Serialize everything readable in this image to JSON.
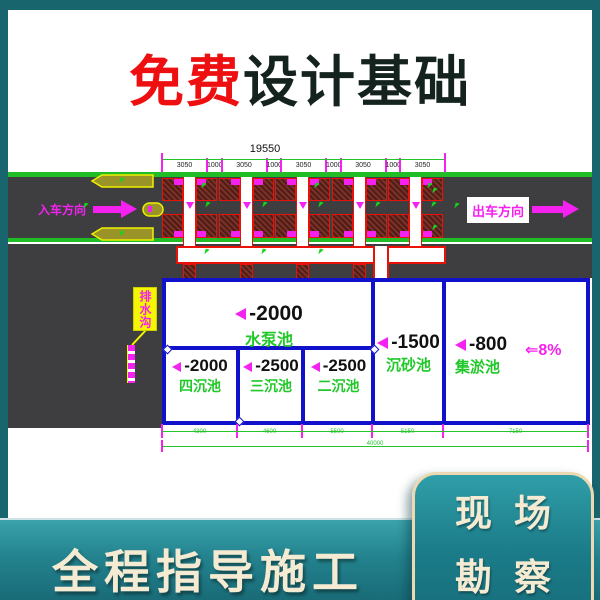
{
  "title": {
    "highlight": "免费",
    "rest": "设计基础",
    "highlight_color": "#ee1010",
    "rest_color": "#15231f"
  },
  "drawing": {
    "dim_total_top": "19550",
    "dims_top": [
      "3050",
      "1000",
      "3050",
      "1000",
      "3050",
      "1000",
      "3050",
      "1000",
      "3050"
    ],
    "entry_label": "入车方向",
    "exit_label": "出车方向",
    "drain_label": "排水沟",
    "slope_label": "⇐8%",
    "pools": {
      "pump": {
        "level": "-2000",
        "name": "水泵池"
      },
      "sed4": {
        "level": "-2000",
        "name": "四沉池"
      },
      "sed3": {
        "level": "-2500",
        "name": "三沉池"
      },
      "sed2": {
        "level": "-2500",
        "name": "二沉池"
      },
      "sand": {
        "level": "-1500",
        "name": "沉砂池"
      },
      "sludge": {
        "level": "-800",
        "name": "集淤池"
      }
    },
    "dims_bottom": [
      "4300",
      "4600",
      "5500",
      "5150",
      "7150"
    ],
    "dim_total_bottom": "40000",
    "bay_count": 5,
    "colors": {
      "road": "#3e3e40",
      "edge_green": "#21bd27",
      "cad_red": "#ea1208",
      "cad_magenta": "#f421f0",
      "cad_yellow": "#f6f600",
      "pool_blue": "#1111cc",
      "pool_name_green": "#22c82a"
    }
  },
  "footer": {
    "banner": "全程指导施工",
    "badge_line1": "现场",
    "badge_line2": "勘察",
    "teal_background": "#19656d",
    "cream_text": "#f5ead2"
  }
}
